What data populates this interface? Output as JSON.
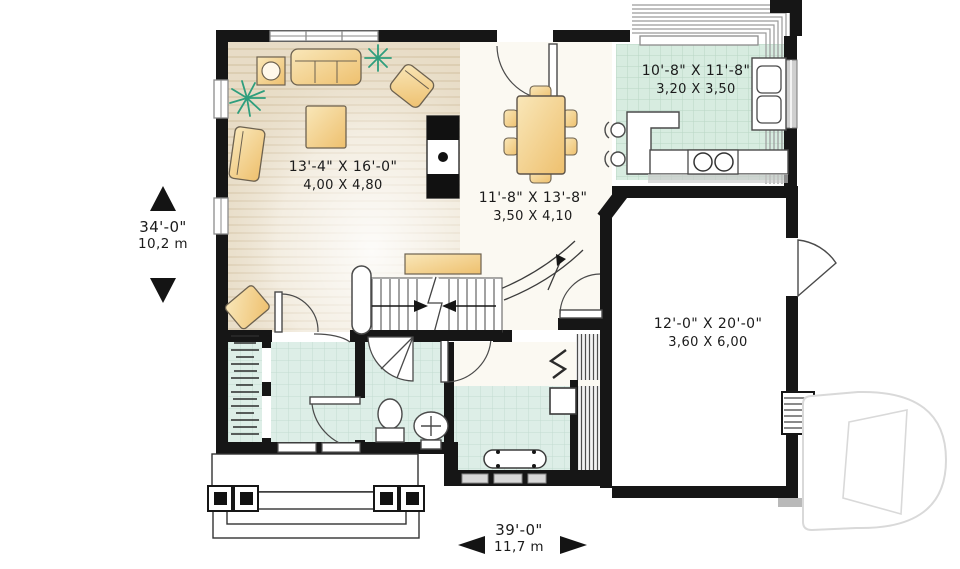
{
  "plan": {
    "overall": {
      "depth_ft": "34'-0\"",
      "depth_m": "10,2 m",
      "width_ft": "39'-0\"",
      "width_m": "11,7 m"
    },
    "rooms": {
      "living": {
        "size_ft": "13'-4\" X 16'-0\"",
        "size_m": "4,00 X 4,80"
      },
      "dining": {
        "size_ft": "11'-8\" X 13'-8\"",
        "size_m": "3,50 X 4,10"
      },
      "kitchen": {
        "size_ft": "10'-8\" X 11'-8\"",
        "size_m": "3,20 X 3,50"
      },
      "garage": {
        "size_ft": "12'-0\" X 20'-0\"",
        "size_m": "3,60 X 6,00"
      }
    },
    "colors": {
      "wall": "#161616",
      "wood_floor": "#eadfc9",
      "tile_floor": "#dcece5",
      "kitchen_tile": "#d8ece1",
      "furniture": "#f3d392",
      "plant": "#2f9e7d",
      "watermark": "#d9d9d9",
      "text": "#1b1b1b"
    },
    "icons": [
      "sofa-icon",
      "armchair-icon",
      "chaise-icon",
      "coffee-table-icon",
      "side-table-lamp-icon",
      "plant-icon",
      "fireplace-icon",
      "dining-table-icon",
      "kitchen-counter-icon",
      "sink-icon",
      "stove-icon",
      "stool-icon",
      "toilet-icon",
      "bath-sink-icon",
      "corner-shower-icon",
      "bench-icon",
      "washer-icon",
      "coat-hooks-icon",
      "stairs-icon",
      "porch-pillar-icon",
      "drummond-logo-watermark"
    ]
  }
}
